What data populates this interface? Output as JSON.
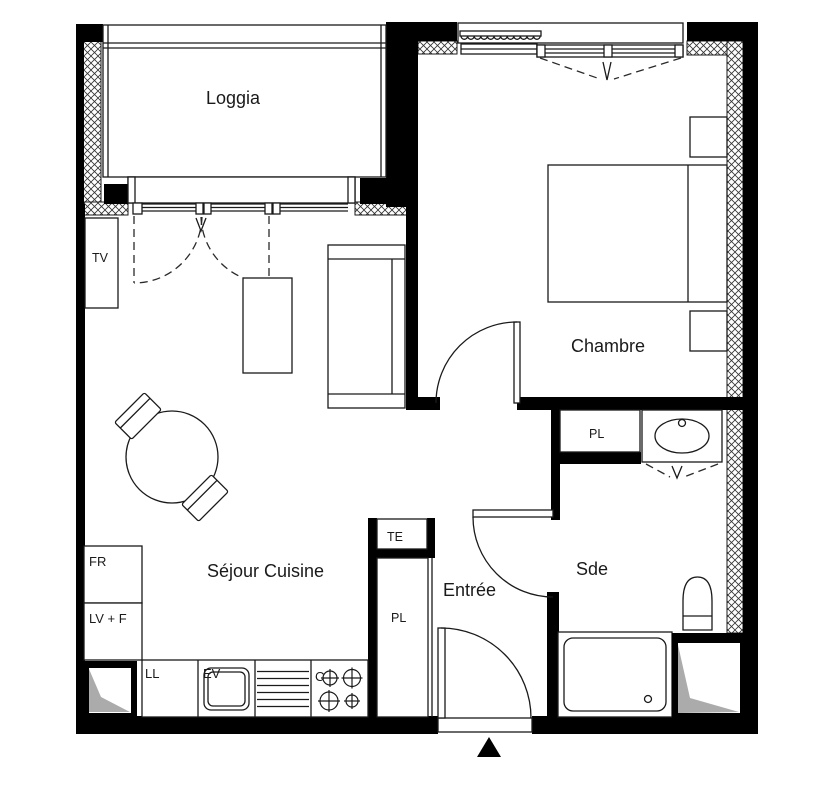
{
  "document": {
    "type": "apartment-floor-plan"
  },
  "rooms": {
    "loggia": "Loggia",
    "chambre": "Chambre",
    "sejour_cuisine": "Séjour Cuisine",
    "entree": "Entrée",
    "sde": "Sde"
  },
  "fixtures": {
    "tv": "TV",
    "fridge": "FR",
    "dishwasher_oven": "LV + F",
    "washing_machine": "LL",
    "kitchen_sink": "EV",
    "cooktop": "C",
    "electrical_box": "TE",
    "closet_entree": "PL",
    "closet_chambre": "PL"
  },
  "colors": {
    "wall": "#000000",
    "line": "#1a1a1a",
    "duct_fill": "#ababab",
    "background": "#ffffff",
    "text": "#1a1a1a"
  }
}
